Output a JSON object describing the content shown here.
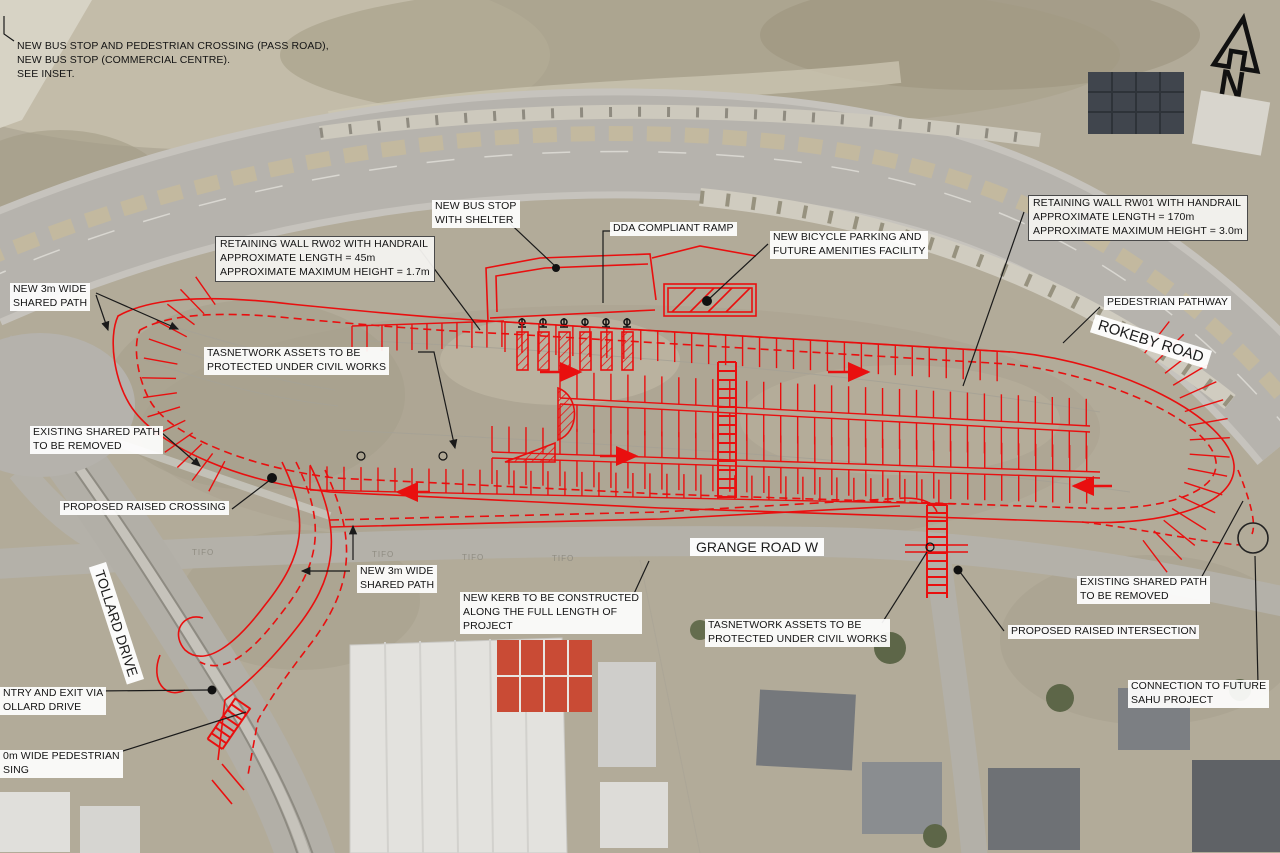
{
  "drawing": {
    "compass_label": "N",
    "roads": {
      "rokeby": "ROKEBY ROAD",
      "grange": "GRANGE ROAD W",
      "tollard": "TOLLARD DRIVE"
    },
    "ground_mark": "TIFO",
    "colors": {
      "design_red": "#e90f0f",
      "leader_black": "#1a1a1a",
      "label_bg": "#ffffff"
    },
    "annotations": [
      {
        "id": "inset-note",
        "text": "NEW BUS STOP AND PEDESTRIAN CROSSING (PASS ROAD),\nNEW BUS STOP (COMMERCIAL CENTRE).\nSEE INSET."
      },
      {
        "id": "retaining-wall-rw02",
        "text": "RETAINING WALL RW02 WITH HANDRAIL\nAPPROXIMATE LENGTH = 45m\nAPPROXIMATE MAXIMUM HEIGHT = 1.7m"
      },
      {
        "id": "new-bus-stop-shelter",
        "text": "NEW BUS STOP\nWITH SHELTER"
      },
      {
        "id": "dda-compliant-ramp",
        "text": "DDA COMPLIANT RAMP"
      },
      {
        "id": "new-bicycle-parking",
        "text": "NEW BICYCLE PARKING AND\nFUTURE AMENITIES FACILITY"
      },
      {
        "id": "retaining-wall-rw01",
        "text": "RETAINING WALL RW01 WITH HANDRAIL\nAPPROXIMATE LENGTH = 170m\nAPPROXIMATE MAXIMUM HEIGHT = 3.0m"
      },
      {
        "id": "pedestrian-pathway",
        "text": "PEDESTRIAN PATHWAY"
      },
      {
        "id": "new-3m-shared-path-top",
        "text": "NEW 3m WIDE\nSHARED PATH"
      },
      {
        "id": "tasnetwork-assets-upper",
        "text": "TASNETWORK ASSETS TO BE\nPROTECTED UNDER CIVIL WORKS"
      },
      {
        "id": "existing-shared-path-left",
        "text": "EXISTING SHARED PATH\nTO BE REMOVED"
      },
      {
        "id": "proposed-raised-crossing",
        "text": "PROPOSED RAISED CROSSING"
      },
      {
        "id": "new-3m-shared-path-lower",
        "text": "NEW 3m WIDE\nSHARED PATH"
      },
      {
        "id": "new-kerb",
        "text": "NEW KERB TO BE CONSTRUCTED\nALONG THE FULL LENGTH OF\nPROJECT"
      },
      {
        "id": "tasnetwork-assets-lower",
        "text": "TASNETWORK ASSETS TO BE\nPROTECTED UNDER CIVIL WORKS"
      },
      {
        "id": "proposed-raised-intersection",
        "text": "PROPOSED RAISED INTERSECTION"
      },
      {
        "id": "existing-shared-path-right",
        "text": "EXISTING SHARED PATH\nTO BE REMOVED"
      },
      {
        "id": "connection-sahu",
        "text": "CONNECTION TO FUTURE\nSAHU PROJECT"
      },
      {
        "id": "entry-exit-tollard",
        "text": "NTRY AND EXIT VIA\nOLLARD DRIVE"
      },
      {
        "id": "pedestrian-crossing-cut",
        "text": "0m WIDE PEDESTRIAN\nSING"
      }
    ]
  }
}
